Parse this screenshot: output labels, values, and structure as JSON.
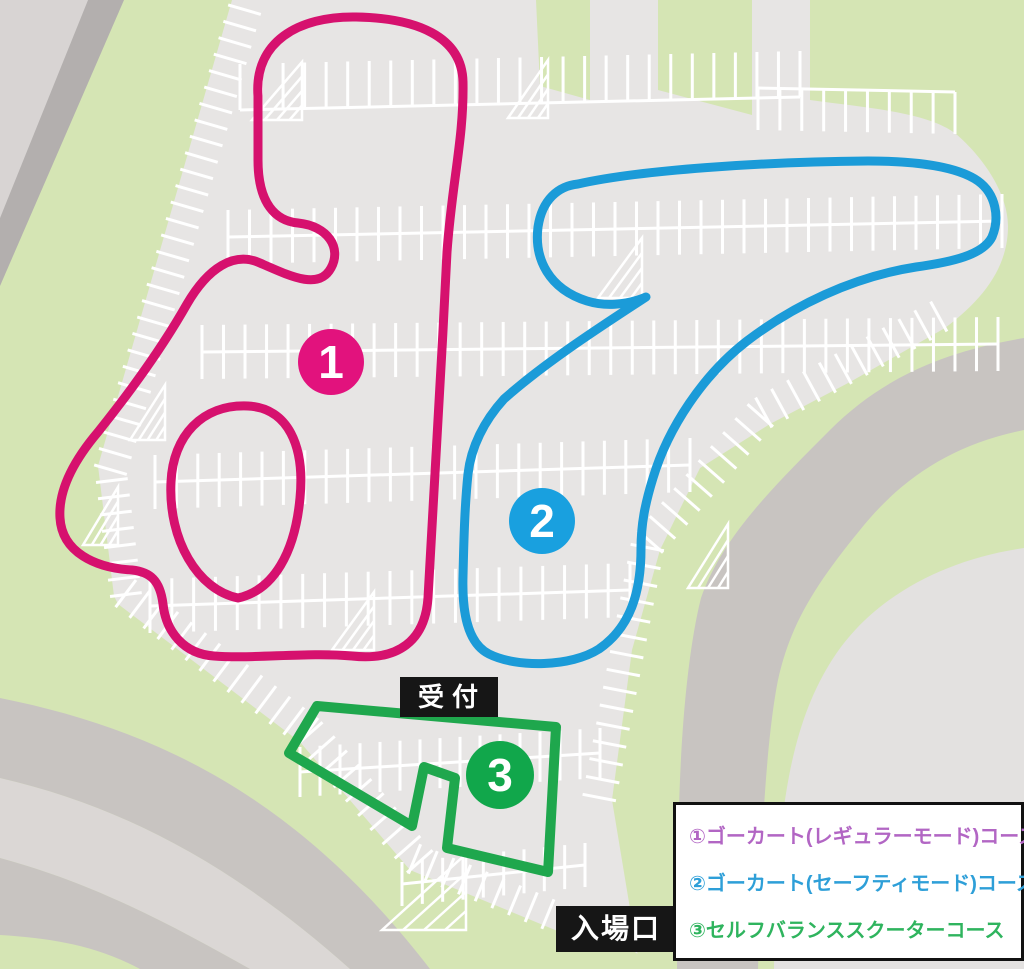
{
  "map": {
    "labels": {
      "reception": "受付",
      "entrance": "入場口"
    },
    "markers": [
      {
        "number": "1",
        "color": "#E2127D"
      },
      {
        "number": "2",
        "color": "#19A0DF"
      },
      {
        "number": "3",
        "color": "#11A74B"
      }
    ],
    "courses": [
      {
        "id": "1",
        "name": "ゴーカート(レギュラーモード)コース",
        "color": "#D6116E"
      },
      {
        "id": "2",
        "name": "ゴーカート(セーフティモード)コース",
        "color": "#1B9BD8"
      },
      {
        "id": "3",
        "name": "セルフバランススクーターコース",
        "color": "#1FA74D"
      }
    ],
    "legend": {
      "items": [
        {
          "label": "①ゴーカート(レギュラーモード)コース",
          "color": "#B266C4"
        },
        {
          "label": "②ゴーカート(セーフティモード)コース",
          "color": "#2E9FD8"
        },
        {
          "label": "③セルフバランススクーターコース",
          "color": "#2FB45E"
        }
      ]
    },
    "palette": {
      "parking": "#E7E5E4",
      "grass": "#D5E5B4",
      "road": "#C8C4C1",
      "road_light": "#D8D4D3",
      "road_dark": "#B3AFAE",
      "road_wedge": "#DBD7D5",
      "corner_patch": "#E3E1E0",
      "stall_line": "#FFFFFF",
      "label_bg": "#161616",
      "label_text": "#FFFFFF",
      "legend_bg": "#FFFFFF",
      "legend_border": "#111111"
    }
  }
}
